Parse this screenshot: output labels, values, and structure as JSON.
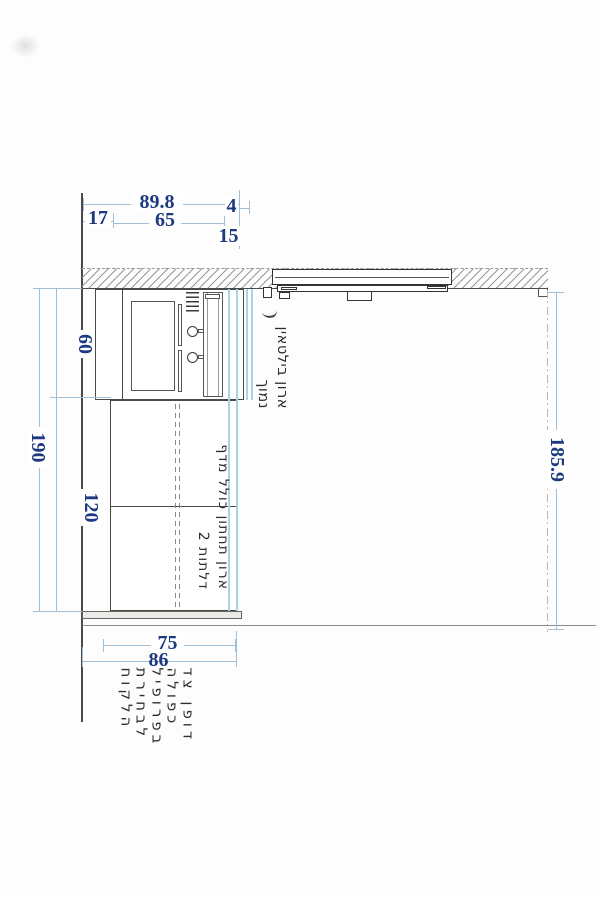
{
  "drawing_title": "cabinet-section-elevation",
  "colors": {
    "dimension_text": "#1d3a80",
    "dimension_line": "#9fc0d8",
    "construction_line_cyan": "#a9d4e4",
    "drawing_line": "#4a4a4a",
    "background": "#ffffff"
  },
  "dims": {
    "top": {
      "total": "89.8",
      "left": "17",
      "mid": "65",
      "gap": "4",
      "depth": "15"
    },
    "left": {
      "upper": "60",
      "total": "190",
      "lower": "120"
    },
    "right": {
      "total": "185.9"
    },
    "bottom": {
      "inner": "75",
      "outer": "86"
    }
  },
  "annotations": {
    "upper_cabinet": {
      "line1": "ארון בילטאין",
      "line2": "נמוך"
    },
    "lower_cabinet": {
      "line1": "ארון תחתון כולל מדף",
      "line2": "דלתות 2"
    },
    "side_panel": {
      "line1": "דופן צד",
      "line2": "כפולה",
      "line3": "בפרופיל",
      "line4": "לבחירת",
      "line5": "הלקוח"
    }
  }
}
